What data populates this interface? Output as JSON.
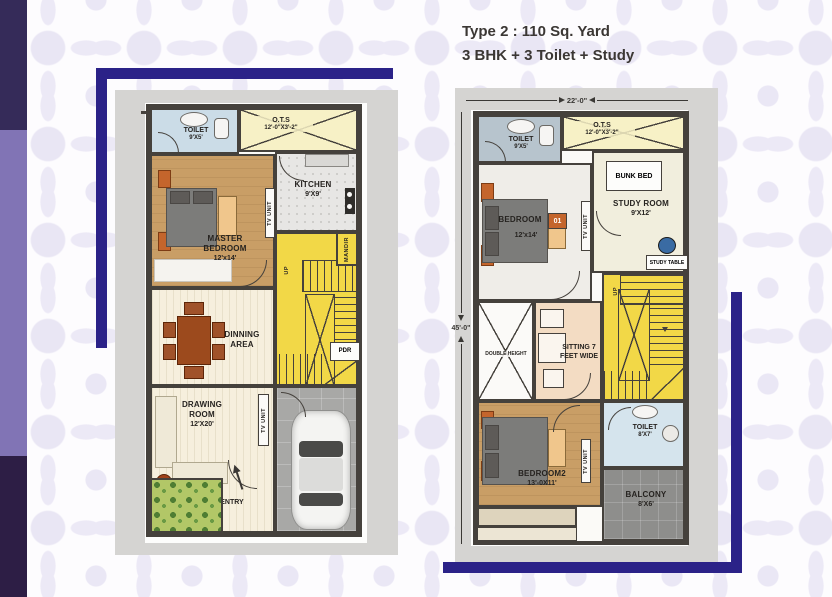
{
  "title": {
    "line1": "Type 2 : 110 Sq. Yard",
    "line2": "3 BHK + 3 Toilet + Study"
  },
  "ground_floor": {
    "toilet_name": "TOILET",
    "toilet_dim": "9'X5'",
    "ots_name": "O.T.S",
    "ots_dim": "12'-0\"X3'-2\"",
    "kitchen_name": "KITCHEN",
    "kitchen_dim": "9'X9'",
    "master_line1": "MASTER",
    "master_line2": "BEDROOM",
    "master_dim": "12'x14'",
    "tv_unit": "TV UNIT",
    "mandir": "MANDIR",
    "up": "UP",
    "pdr": "PDR",
    "dinning_line1": "DINNING",
    "dinning_line2": "AREA",
    "drawing_line1": "DRAWING",
    "drawing_line2": "ROOM",
    "drawing_dim": "12'X20'",
    "entry": "ENTRY"
  },
  "first_floor": {
    "width_dim": "22'-0\"",
    "height_dim": "45'-0\"",
    "toilet_top_name": "TOILET",
    "toilet_top_dim": "9'X5'",
    "ots_name": "O.T.S",
    "ots_dim": "12'-0\"X3'-2\"",
    "bunk_bed": "BUNK BED",
    "study_name": "STUDY ROOM",
    "study_dim": "9'X12'",
    "study_table": "STUDY TABLE",
    "bedroom1_name": "BEDROOM",
    "bedroom1_no": "01",
    "bedroom1_dim": "12'x14'",
    "tv_unit": "TV UNIT",
    "up": "UP",
    "double_height": "DOUBLE HEIGHT",
    "sitting_line1": "SITTING 7",
    "sitting_line2": "FEET WIDE",
    "bedroom2_name": "BEDROOM2",
    "bedroom2_dim": "13'-0X11'",
    "toilet_bottom_name": "TOILET",
    "toilet_bottom_dim": "8'X7'",
    "balcony_name": "BALCONY",
    "balcony_dim": "8'X6'"
  },
  "colors": {
    "frame_blue": "#2b2288",
    "side_bar_dark_top": "#352b59",
    "side_bar_mid": "#8174b5",
    "side_bar_dark_bottom": "#2d1e45",
    "stairs_yellow": "#f2d847",
    "wood_tan": "#c99e66",
    "toilet_blue": "#cbdce7"
  }
}
